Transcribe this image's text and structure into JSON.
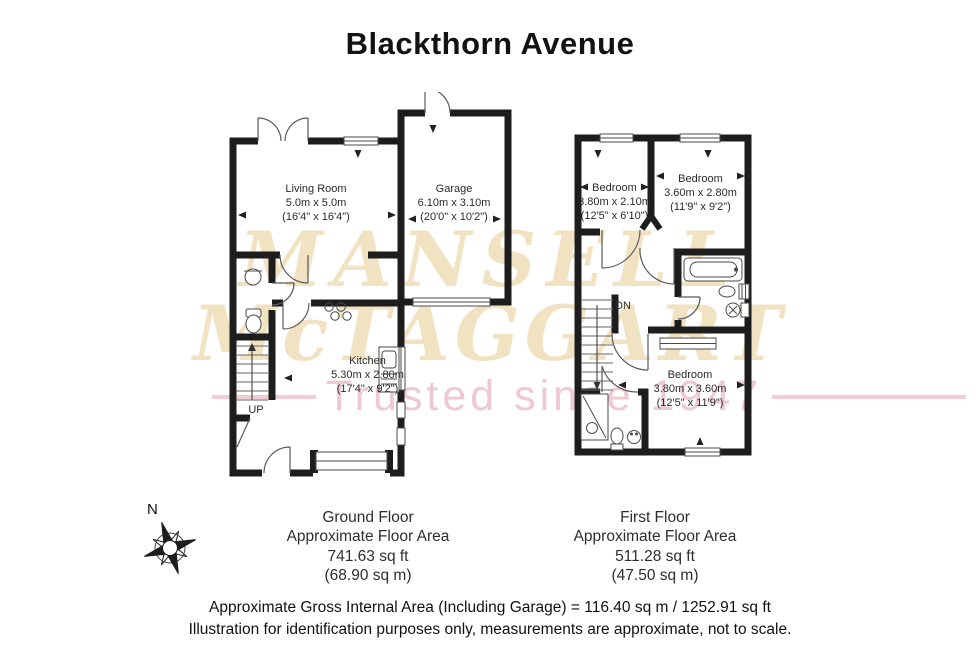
{
  "title": "Blackthorn Avenue",
  "watermark": {
    "brand_line1": "MANSELL",
    "brand_line2": "McTAGGART",
    "tagline": "Trusted since 1947",
    "brand_color": "#f1e2c2",
    "tagline_color": "#eec9d1"
  },
  "compass": {
    "north_label": "N"
  },
  "ground_floor": {
    "stairs_label": "UP",
    "rooms": [
      {
        "name": "Living Room",
        "size_metric": "5.0m x 5.0m",
        "size_imperial": "(16'4\" x 16'4\")"
      },
      {
        "name": "Garage",
        "size_metric": "6.10m x 3.10m",
        "size_imperial": "(20'0\" x 10'2\")"
      },
      {
        "name": "Kitchen",
        "size_metric": "5.30m x 2.80m",
        "size_imperial": "(17'4\" x 9'2\")"
      }
    ],
    "summary": {
      "floor_name": "Ground Floor",
      "area_label": "Approximate Floor Area",
      "area_sqft": "741.63 sq ft",
      "area_sqm": "(68.90 sq m)"
    }
  },
  "first_floor": {
    "stairs_label": "DN",
    "rooms": [
      {
        "name": "Bedroom",
        "size_metric": "3.80m x 2.10m",
        "size_imperial": "(12'5\" x 6'10\")"
      },
      {
        "name": "Bedroom",
        "size_metric": "3.60m x 2.80m",
        "size_imperial": "(11'9\" x 9'2\")"
      },
      {
        "name": "Bedroom",
        "size_metric": "3.80m x 3.60m",
        "size_imperial": "(12'5\" x 11'9\")"
      }
    ],
    "summary": {
      "floor_name": "First Floor",
      "area_label": "Approximate Floor Area",
      "area_sqft": "511.28 sq ft",
      "area_sqm": "(47.50 sq m)"
    }
  },
  "footer": {
    "gross_area_line": "Approximate Gross Internal Area (Including Garage) = 116.40 sq m / 1252.91 sq ft",
    "disclaimer_line": "Illustration for identification purposes only, measurements are approximate, not to scale."
  }
}
